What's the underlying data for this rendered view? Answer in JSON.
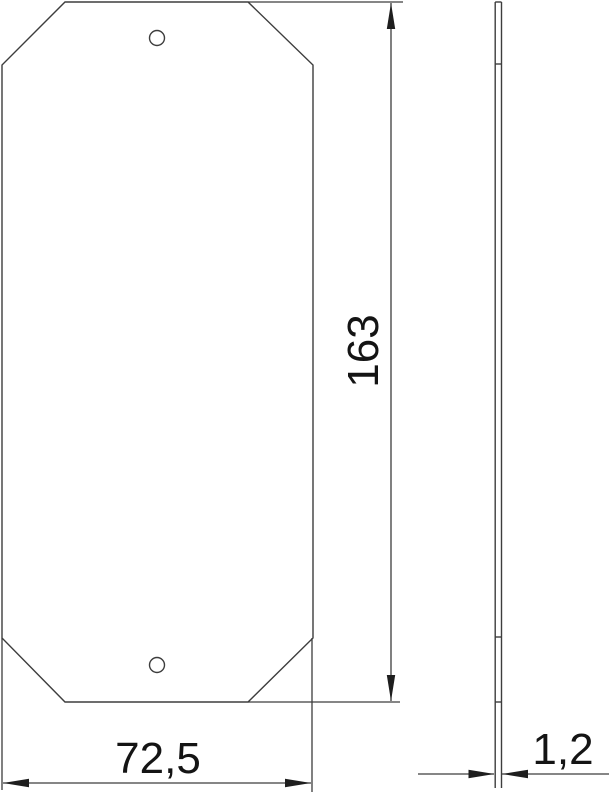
{
  "colors": {
    "background": "#ffffff",
    "line": "#3d3d3d",
    "arrow": "#1e1e1e",
    "text": "#141414"
  },
  "drawing": {
    "kind": "technical-dimension-drawing",
    "front_view": {
      "shape": "plate-with-chamfered-corners",
      "hole_count": "2"
    },
    "side_view": {
      "shape": "thin-plate-profile"
    }
  },
  "dimensions": {
    "height": {
      "label": "163",
      "orientation": "vertical"
    },
    "width": {
      "label": "72,5",
      "orientation": "horizontal"
    },
    "thickness": {
      "label": "1,2",
      "orientation": "horizontal"
    }
  }
}
